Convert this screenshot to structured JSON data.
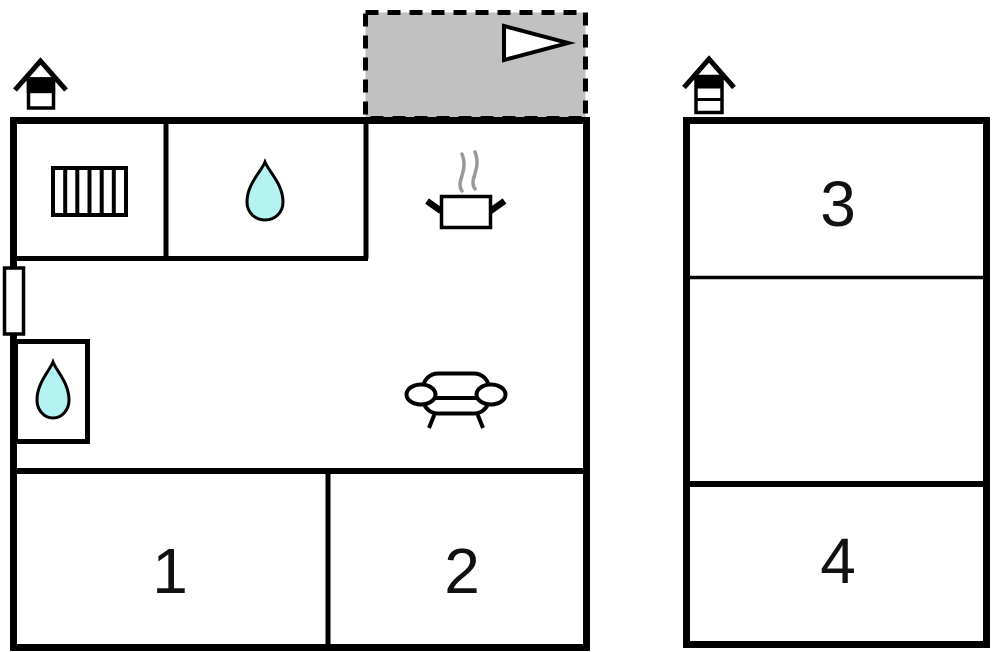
{
  "colors": {
    "background": "#ffffff",
    "wall": "#000000",
    "terrace_fill": "#c1c1c1",
    "water_drop_fill": "#b5f2f2",
    "steam": "#999999",
    "icon_outline": "#000000"
  },
  "terrace": {
    "name": "terrace",
    "outline_style": "dashed",
    "arrow_icon": "right-arrow-icon"
  },
  "main_building": {
    "room1_label": "1",
    "room2_label": "2",
    "icons": [
      "chimney-icon",
      "radiator-icon",
      "water-drop-icon",
      "cooking-pot-icon",
      "steam-icon",
      "sofa-icon",
      "water-drop-icon"
    ]
  },
  "annex_building": {
    "room3_label": "3",
    "room4_label": "4",
    "icons": [
      "chimney-icon"
    ]
  }
}
